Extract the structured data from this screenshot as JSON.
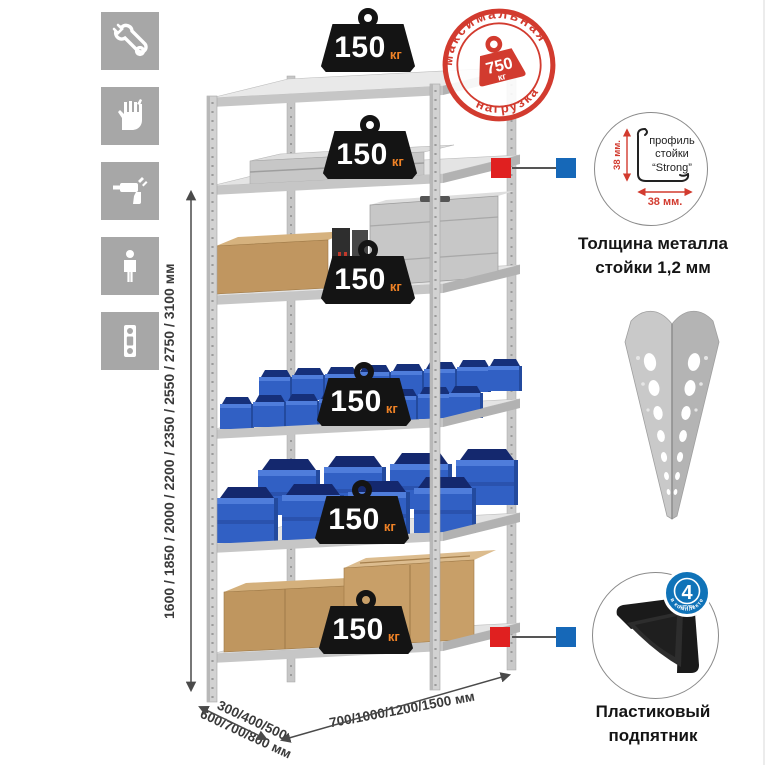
{
  "colors": {
    "stamp_red": "#d23b2f",
    "marker_red": "#e02020",
    "marker_blue": "#1668b8",
    "bin_blue": "#3160c4",
    "badge_black": "#141414",
    "unit_orange": "#ef8226",
    "metal_gray": "#d2d2d2",
    "icon_gray": "#a7a7a7"
  },
  "tool_icons": [
    {
      "name": "wrench"
    },
    {
      "name": "gloves"
    },
    {
      "name": "drill"
    },
    {
      "name": "person-height"
    },
    {
      "name": "spirit-level"
    }
  ],
  "rack": {
    "shelf_count": 6,
    "load_unit": "кг",
    "shelf_loads": [
      "150",
      "150",
      "150",
      "150",
      "150",
      "150"
    ]
  },
  "max_load_stamp": {
    "arc_top": "максимальная",
    "arc_bottom": "нагрузка",
    "value": "750",
    "unit": "кг"
  },
  "dimensions": {
    "height": "1600 / 1850 / 2000 / 2200 / 2350 / 2550 / 2750 / 3100 мм",
    "depth_line1": "300/400/500",
    "depth_line2": "600/700/800 мм",
    "width": "700/1000/1200/1500 мм"
  },
  "profile_detail": {
    "line1": "профиль",
    "line2": "стойки",
    "line3": "“Strong”",
    "dim_vertical": "38 мм.",
    "dim_horizontal": "38 мм.",
    "caption_line1": "Толщина металла",
    "caption_line2": "стойки 1,2 мм"
  },
  "foot_detail": {
    "badge_value": "4",
    "badge_small": "штуки",
    "badge_arc": "в комплекте",
    "caption_line1": "Пластиковый",
    "caption_line2": "подпятник"
  }
}
